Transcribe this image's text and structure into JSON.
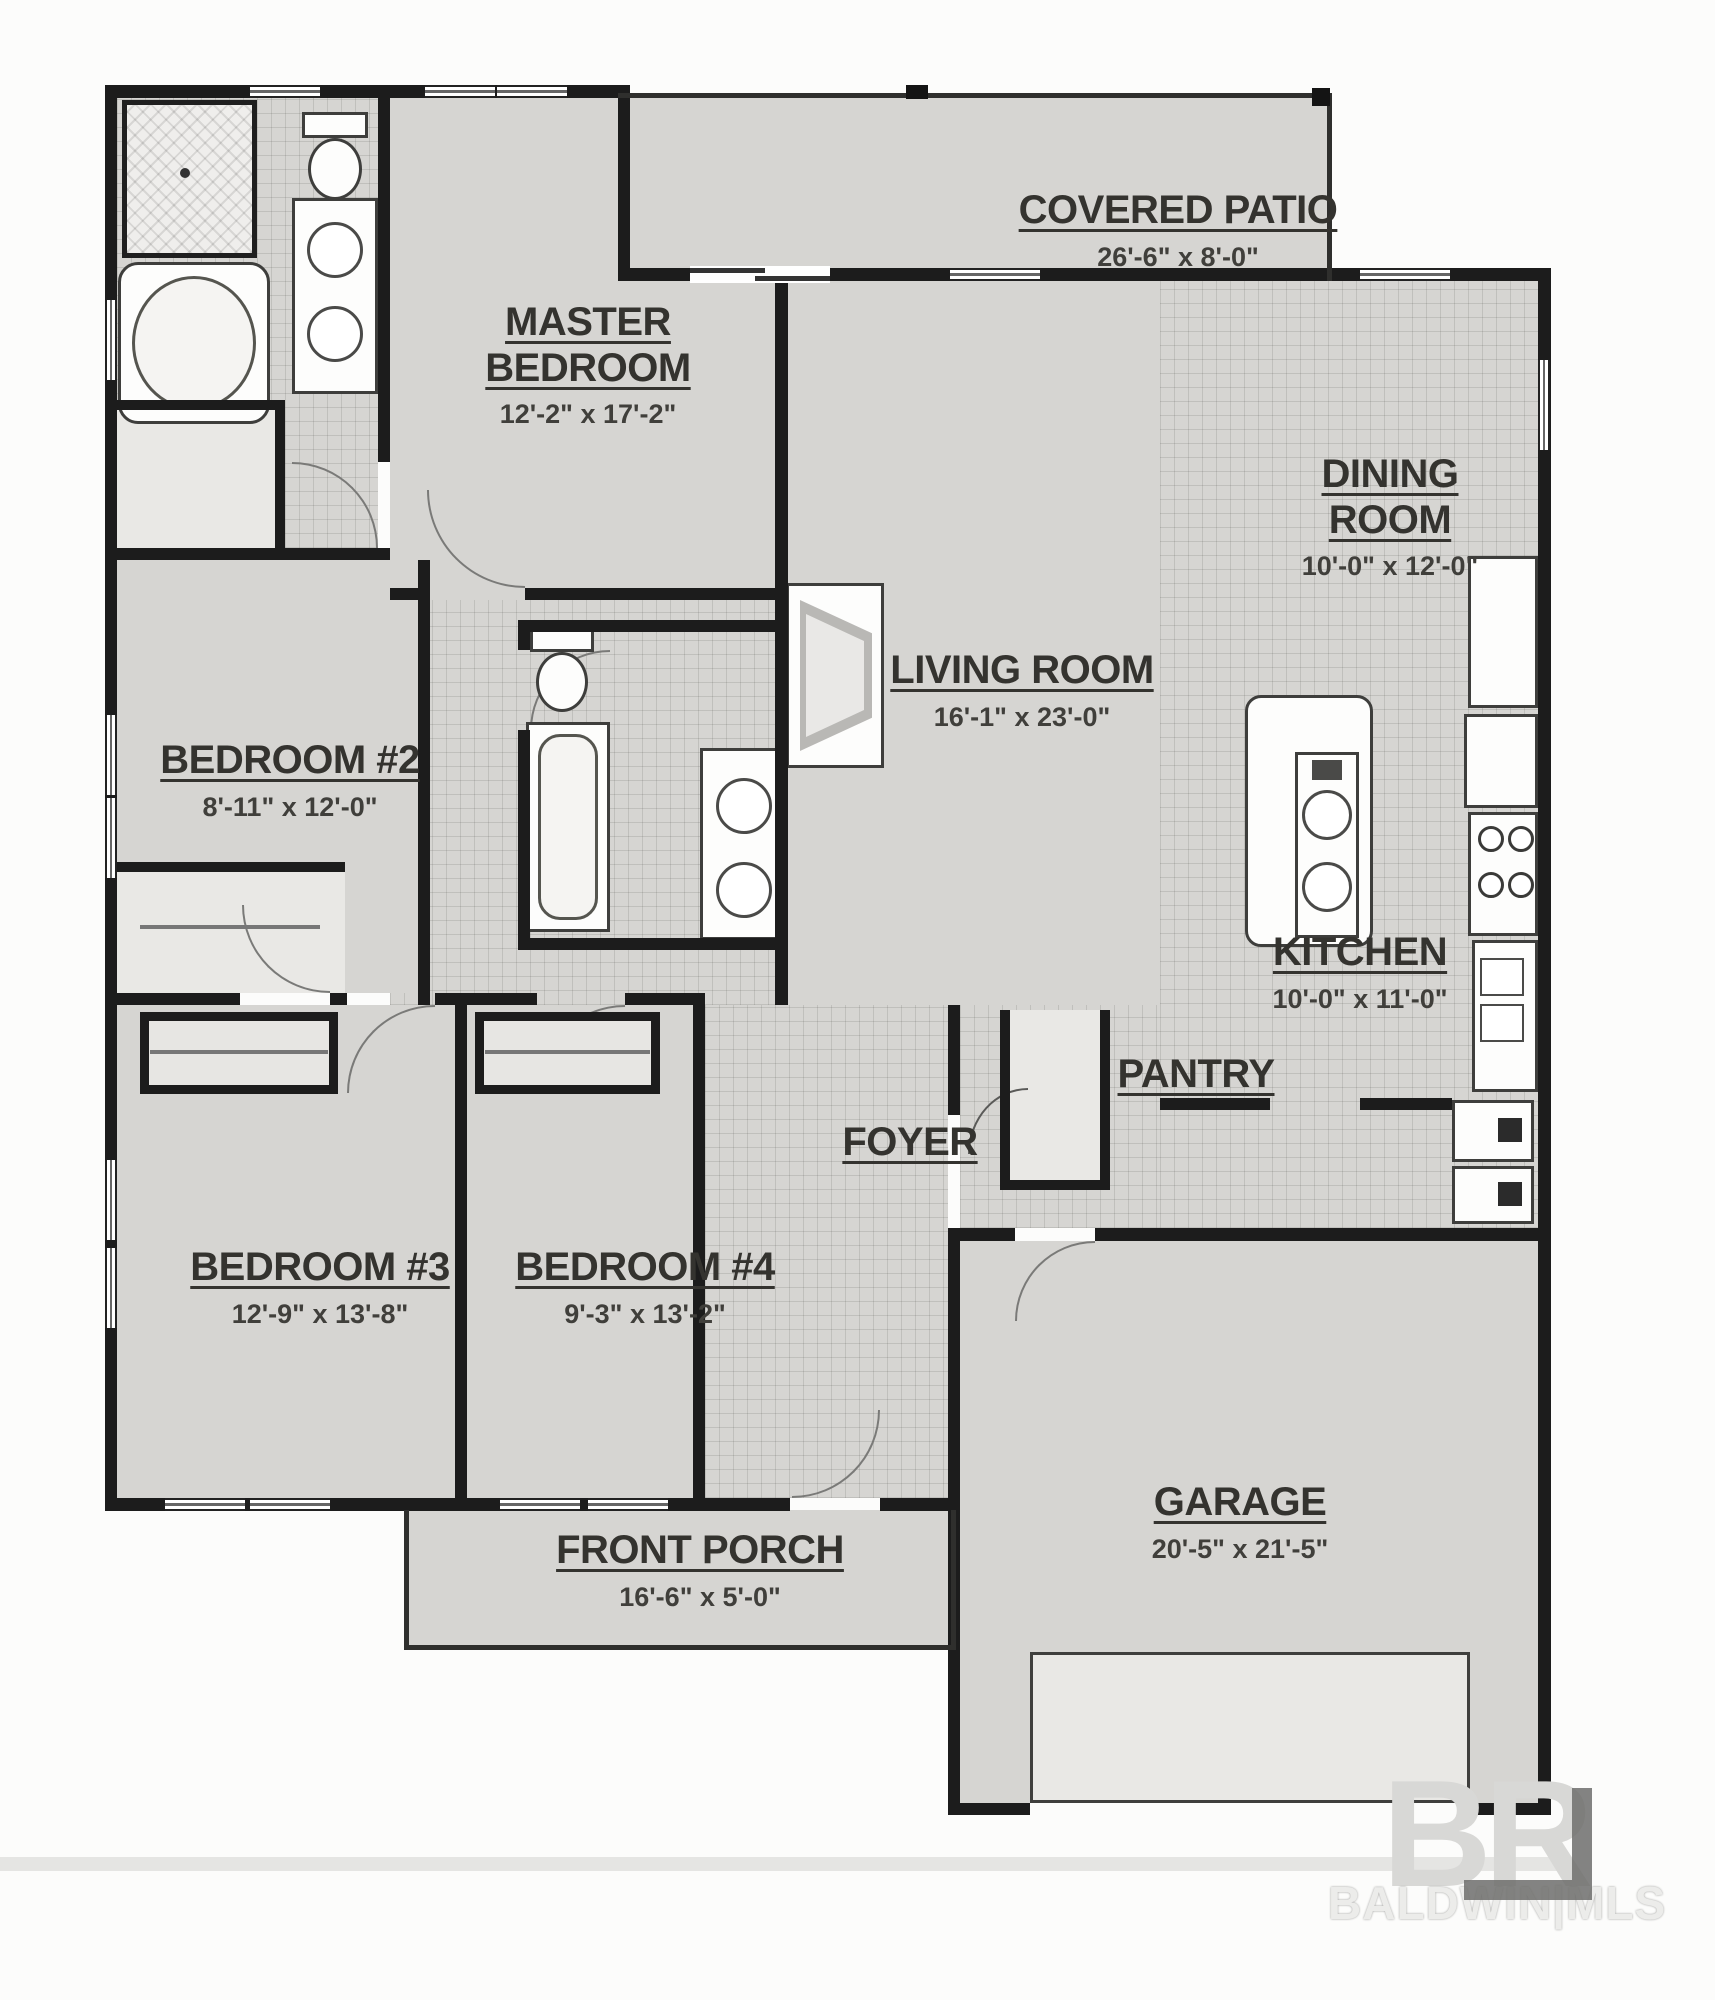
{
  "rooms": {
    "covered_patio": {
      "name": "COVERED PATIO",
      "dim": "26'-6\" x 8'-0\""
    },
    "master_bedroom": {
      "name": "MASTER BEDROOM",
      "dim": "12'-2\" x 17'-2\""
    },
    "dining_room": {
      "name": "DINING ROOM",
      "dim": "10'-0\" x 12'-0\""
    },
    "living_room": {
      "name": "LIVING ROOM",
      "dim": "16'-1\" x 23'-0\""
    },
    "bedroom_2": {
      "name": "BEDROOM #2",
      "dim": "8'-11\" x 12'-0\""
    },
    "kitchen": {
      "name": "KITCHEN",
      "dim": "10'-0\" x 11'-0\""
    },
    "pantry": {
      "name": "PANTRY",
      "dim": ""
    },
    "foyer": {
      "name": "FOYER",
      "dim": ""
    },
    "bedroom_3": {
      "name": "BEDROOM #3",
      "dim": "12'-9\" x 13'-8\""
    },
    "bedroom_4": {
      "name": "BEDROOM #4",
      "dim": "9'-3\" x 13'-2\""
    },
    "front_porch": {
      "name": "FRONT PORCH",
      "dim": "16'-6\" x 5'-0\""
    },
    "garage": {
      "name": "GARAGE",
      "dim": "20'-5\" x 21'-5\""
    }
  },
  "watermark": {
    "logo": "BR",
    "text": "BALDWIN|MLS"
  },
  "fixtures": [
    "shower",
    "garden-tub",
    "toilet",
    "double-vanity-sinks",
    "bathtub",
    "fireplace",
    "kitchen-island-sink",
    "refrigerator",
    "cooktop",
    "counter-sink",
    "washer",
    "dryer"
  ],
  "colors": {
    "wall": "#1c1c1c",
    "floor": "#d6d5d2",
    "label": "#34332f",
    "watermark": "#d8d8d6"
  }
}
